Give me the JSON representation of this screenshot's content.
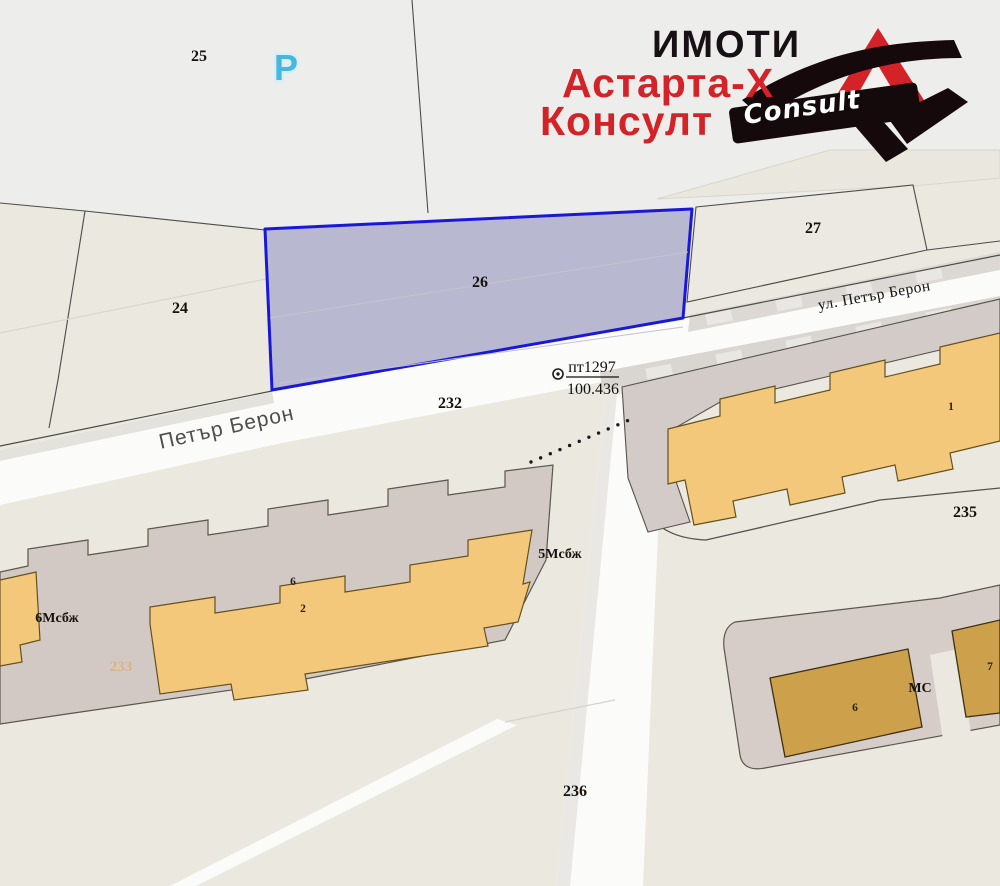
{
  "logo": {
    "line1": "ИМОТИ",
    "line2": "Астарта-Х",
    "line3": "Консулт",
    "mark_text": "Consult",
    "text_color_primary": "#171014",
    "text_color_accent": "#d42328"
  },
  "map": {
    "parcel_labels": [
      {
        "text": "25",
        "x": 199,
        "y": 61
      },
      {
        "text": "24",
        "x": 180,
        "y": 313
      },
      {
        "text": "26",
        "x": 480,
        "y": 287
      },
      {
        "text": "27",
        "x": 813,
        "y": 233
      },
      {
        "text": "232",
        "x": 450,
        "y": 408
      },
      {
        "text": "235",
        "x": 965,
        "y": 517
      },
      {
        "text": "236",
        "x": 575,
        "y": 796
      },
      {
        "text": "233",
        "x": 121,
        "y": 671,
        "muted": true
      }
    ],
    "building_labels": [
      {
        "text": "6",
        "x": 293,
        "y": 585,
        "kind": "number"
      },
      {
        "text": "2",
        "x": 303,
        "y": 612,
        "kind": "number"
      },
      {
        "text": "6Мсбж",
        "x": 57,
        "y": 622,
        "kind": "name"
      },
      {
        "text": "5Мсбж",
        "x": 560,
        "y": 558,
        "kind": "name"
      },
      {
        "text": "1",
        "x": 951,
        "y": 410,
        "kind": "number"
      },
      {
        "text": "6",
        "x": 855,
        "y": 711,
        "kind": "number"
      },
      {
        "text": "МС",
        "x": 920,
        "y": 692,
        "kind": "name"
      },
      {
        "text": "7",
        "x": 990,
        "y": 670,
        "kind": "number"
      }
    ],
    "survey_point": {
      "id": "пт1297",
      "elevation": "100.436"
    },
    "streets": [
      {
        "text": "Петър Берон"
      },
      {
        "text": "ул. Петър Берон"
      }
    ],
    "parking_symbol": {
      "text": "P",
      "color": "#47b7de"
    },
    "highlight_parcel": {
      "label": "26",
      "stroke": "#1a18d8",
      "fill": "#b4b3cf"
    }
  }
}
